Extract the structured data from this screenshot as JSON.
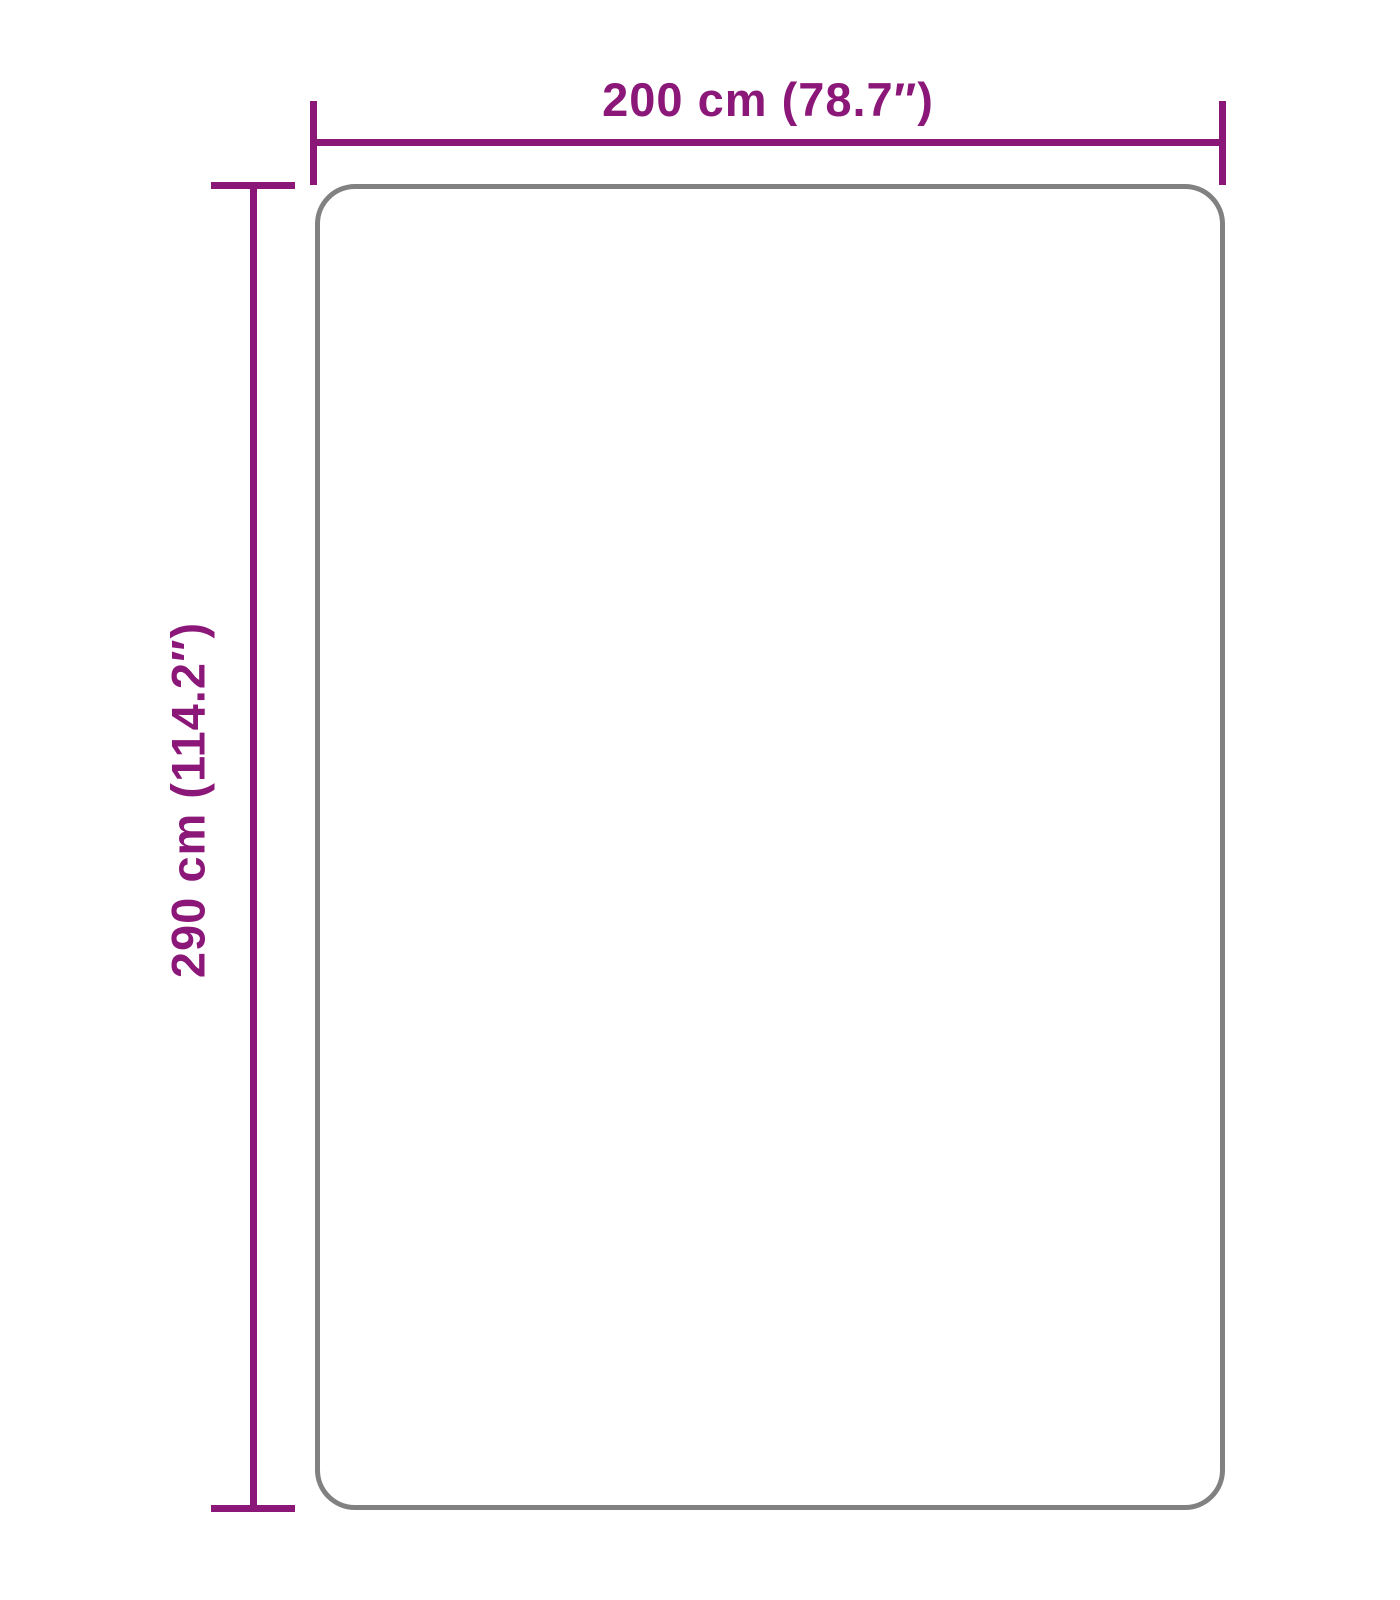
{
  "diagram": {
    "type": "product-dimension-diagram",
    "width_label": "200 cm (78.7″)",
    "height_label": "290 cm (114.2″)",
    "width_value_cm": 200,
    "width_value_inches": 78.7,
    "height_value_cm": 290,
    "height_value_inches": 114.2,
    "colors": {
      "dimension": "#8B1778",
      "outline": "#818181",
      "background": "#FFFFFF"
    }
  }
}
